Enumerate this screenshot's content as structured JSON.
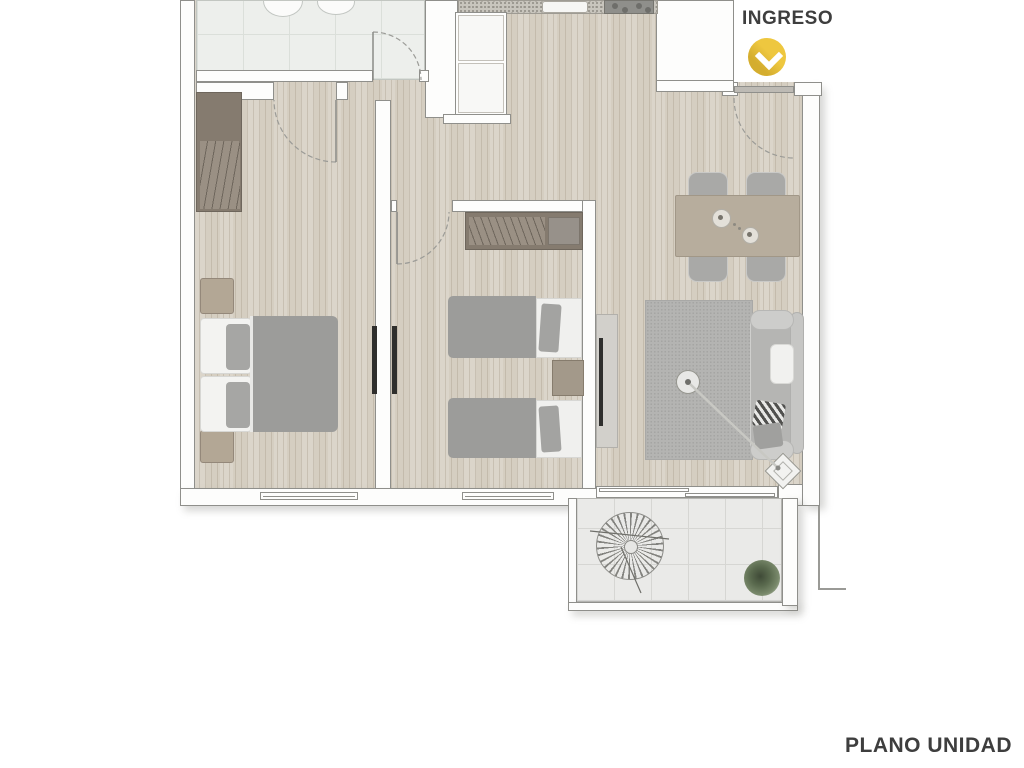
{
  "plan": {
    "entrance_label": "INGRESO",
    "title": "PLANO UNIDAD"
  },
  "icons": {
    "entrance_marker": "chevron-down"
  },
  "colors": {
    "entrance_marker_yellow": "#eec73f",
    "label_text": "#3e3e3e",
    "wood_floor": "#d5cec1",
    "bathroom_tile": "#edefec",
    "balcony_tile": "#eaeae8",
    "wall_outline": "#8f8f8b",
    "furniture_gray": "#9c9c9a",
    "dining_table_beige": "#b7ad9d"
  }
}
